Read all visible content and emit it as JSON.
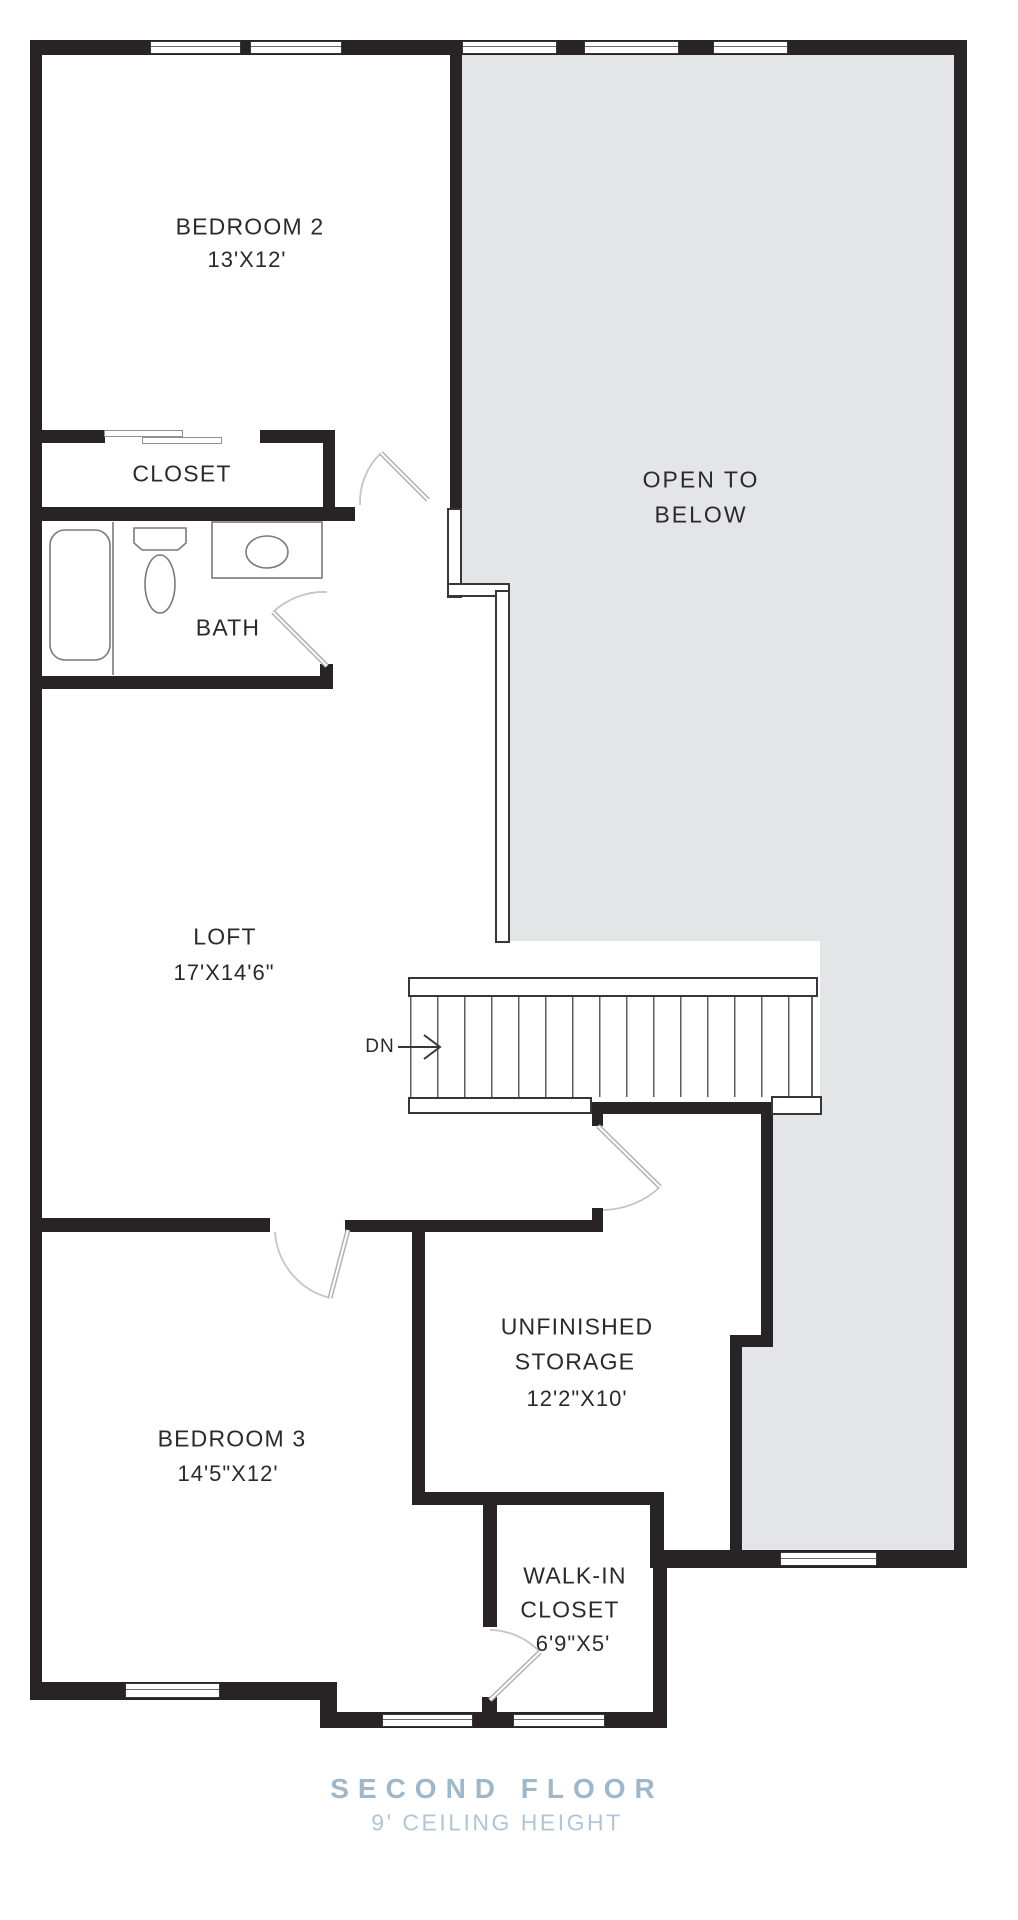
{
  "plan_title": "Second floor residential floor plan",
  "rooms": {
    "bedroom2": {
      "name": "BEDROOM 2",
      "dims": "13'X12'"
    },
    "closet": {
      "name": "CLOSET"
    },
    "bath": {
      "name": "BATH"
    },
    "open_to_below": {
      "line1": "OPEN TO",
      "line2": "BELOW"
    },
    "loft": {
      "name": "LOFT",
      "dims": "17'X14'6\""
    },
    "storage": {
      "line1": "UNFINISHED",
      "line2": "STORAGE",
      "dims": "12'2\"X10'"
    },
    "bedroom3": {
      "name": "BEDROOM 3",
      "dims": "14'5\"X12'"
    },
    "walk_in": {
      "line1": "WALK-IN",
      "line2": "CLOSET",
      "dims": "6'9\"X5'"
    }
  },
  "stairs": {
    "label": "DN"
  },
  "footer": {
    "title": "SECOND FLOOR",
    "subtitle": "9' CEILING HEIGHT"
  },
  "colors": {
    "wall": "#282425",
    "open_area_fill": "#e4e5e6",
    "door_swing": "#b7b8b7",
    "text": "#2d292a",
    "title": "#9fb7ca",
    "subtitle": "#b0c5d5"
  }
}
